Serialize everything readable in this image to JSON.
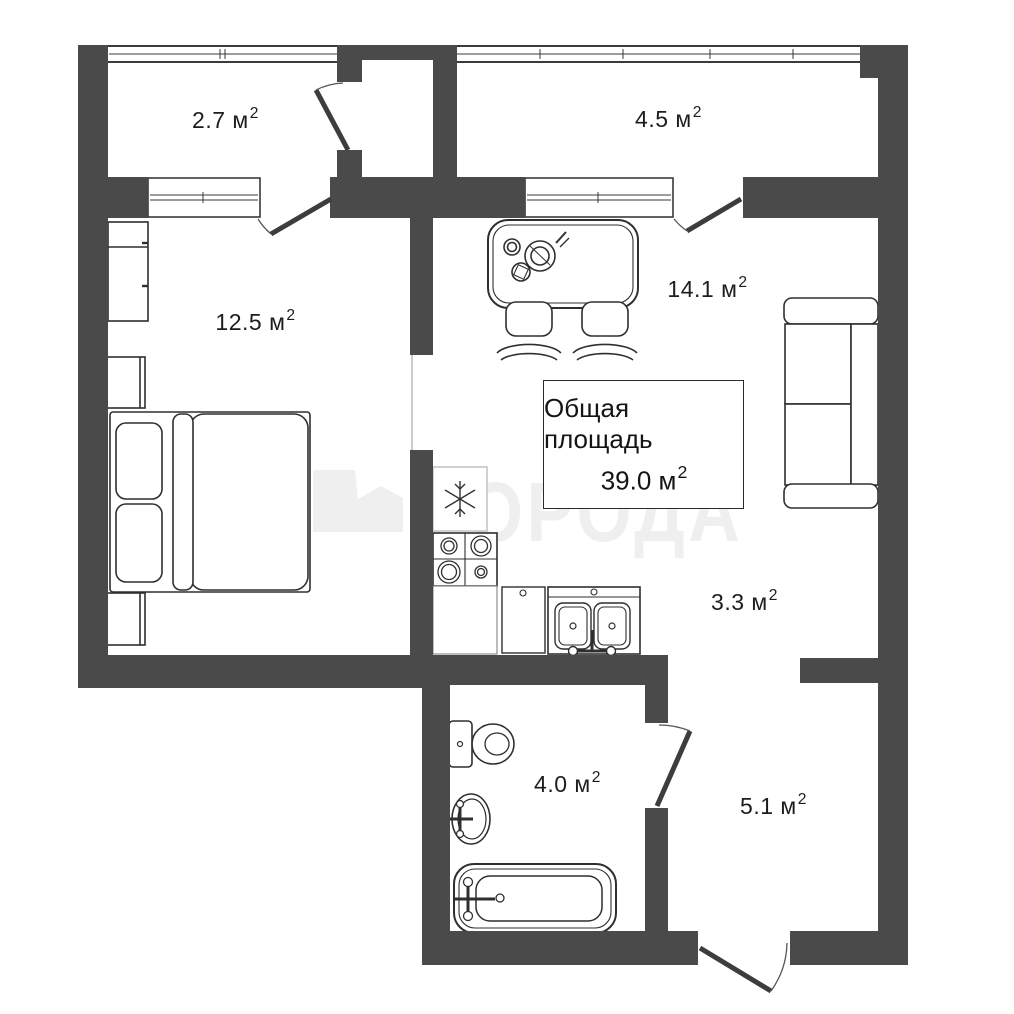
{
  "plan": {
    "total": {
      "title": "Общая площадь",
      "value": "39.0",
      "unit": " м",
      "power": "2"
    },
    "rooms": [
      {
        "name": "balcony-top-left",
        "area": "2.7",
        "unit": " м",
        "power": "2"
      },
      {
        "name": "balcony-top-right",
        "area": "4.5",
        "unit": " м",
        "power": "2"
      },
      {
        "name": "bedroom",
        "area": "12.5",
        "unit": " м",
        "power": "2"
      },
      {
        "name": "living-kitchen",
        "area": "14.1",
        "unit": " м",
        "power": "2"
      },
      {
        "name": "kitchen-passage",
        "area": "3.3",
        "unit": " м",
        "power": "2"
      },
      {
        "name": "bathroom",
        "area": "4.0",
        "unit": " м",
        "power": "2"
      },
      {
        "name": "hallway",
        "area": "5.1",
        "unit": " м",
        "power": "2"
      }
    ],
    "watermark": {
      "text": "ГОРОДА"
    },
    "colors": {
      "wall": "#4a4a4a",
      "outline": "#2f2f2f",
      "door": "#3d3d3d",
      "watermark": "#efefef",
      "label_text": "#1d1d1d",
      "background": "#ffffff"
    }
  }
}
